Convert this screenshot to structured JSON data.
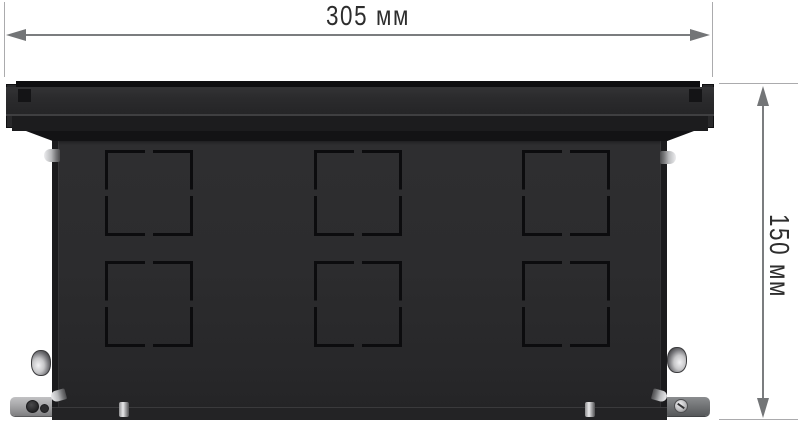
{
  "image": {
    "type": "product-dimension-diagram",
    "subject": "black metal floor-box enclosure, front view, rectangular knockout cut-outs"
  },
  "dimensions": {
    "width": {
      "label": "305 мм"
    },
    "height": {
      "label": "150 мм"
    }
  },
  "knockout_grid": {
    "rows": 2,
    "columns": 3
  },
  "colors": {
    "background": "#ffffff",
    "box_lid": "#2b2b2d",
    "box_body": "#2c2c2e",
    "box_edge": "#1b1b1d",
    "knockout_slot": "#0c0c0e",
    "dimension_line": "#7b7d7f",
    "extension_line": "#ababad",
    "label_text": "#2d2d2d",
    "metal_hardware": "#c8c8ca"
  }
}
